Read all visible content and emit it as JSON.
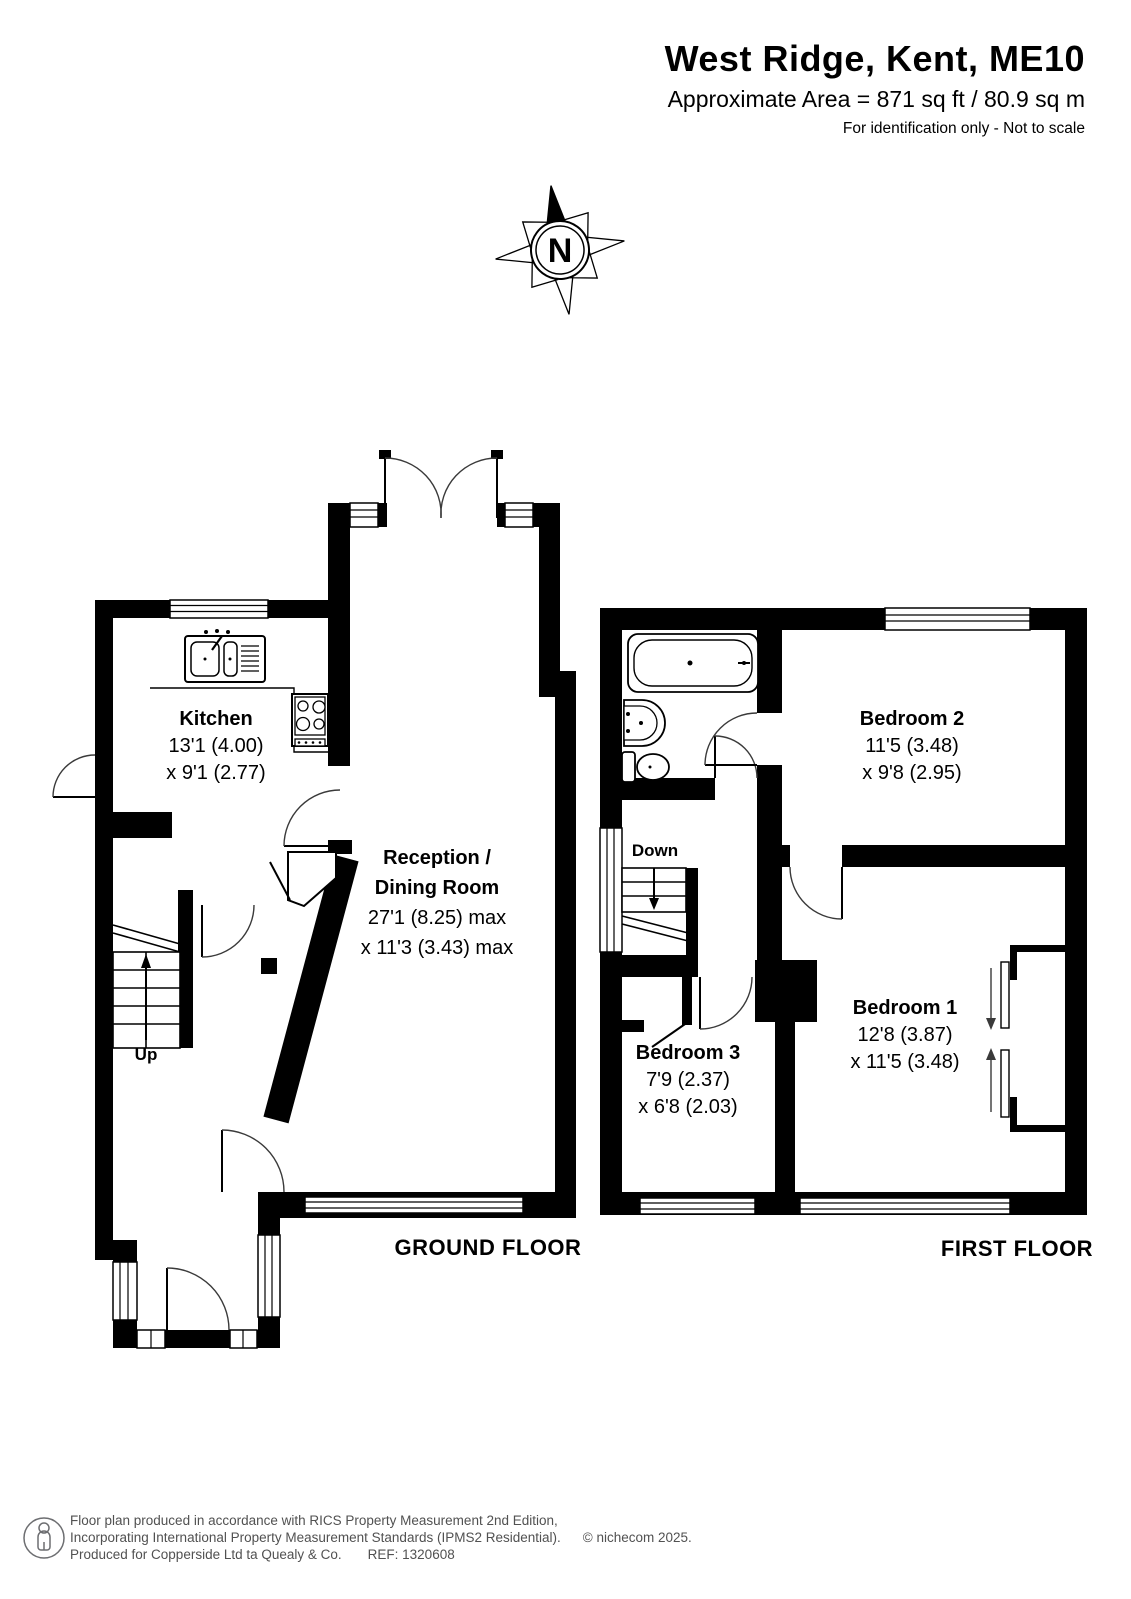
{
  "header": {
    "title": "West Ridge, Kent, ME10",
    "area_line": "Approximate Area = 871 sq ft / 80.9 sq m",
    "disclaimer": "For identification only - Not to scale"
  },
  "compass": {
    "north_label": "N"
  },
  "ground_floor": {
    "floor_label": "GROUND FLOOR",
    "stairs_label": "Up",
    "kitchen": {
      "name": "Kitchen",
      "dim1": "13'1 (4.00)",
      "dim2": "x 9'1 (2.77)"
    },
    "reception": {
      "name_line1": "Reception /",
      "name_line2": "Dining Room",
      "dim1": "27'1 (8.25) max",
      "dim2": "x 11'3 (3.43) max"
    }
  },
  "first_floor": {
    "floor_label": "FIRST FLOOR",
    "stairs_label": "Down",
    "bedroom1": {
      "name": "Bedroom 1",
      "dim1": "12'8 (3.87)",
      "dim2": "x 11'5 (3.48)"
    },
    "bedroom2": {
      "name": "Bedroom 2",
      "dim1": "11'5 (3.48)",
      "dim2": "x 9'8 (2.95)"
    },
    "bedroom3": {
      "name": "Bedroom 3",
      "dim1": "7'9 (2.37)",
      "dim2": "x 6'8 (2.03)"
    }
  },
  "footer": {
    "line1": "Floor plan produced in accordance with RICS Property Measurement 2nd Edition,",
    "line2": "Incorporating International Property Measurement Standards (IPMS2 Residential).",
    "copyright": "© nichecom 2025.",
    "line3": "Produced for Copperside Ltd ta Quealy & Co.",
    "reference": "REF: 1320608"
  },
  "colors": {
    "wall": "#000000",
    "text": "#000000",
    "footer_text": "#515151"
  }
}
